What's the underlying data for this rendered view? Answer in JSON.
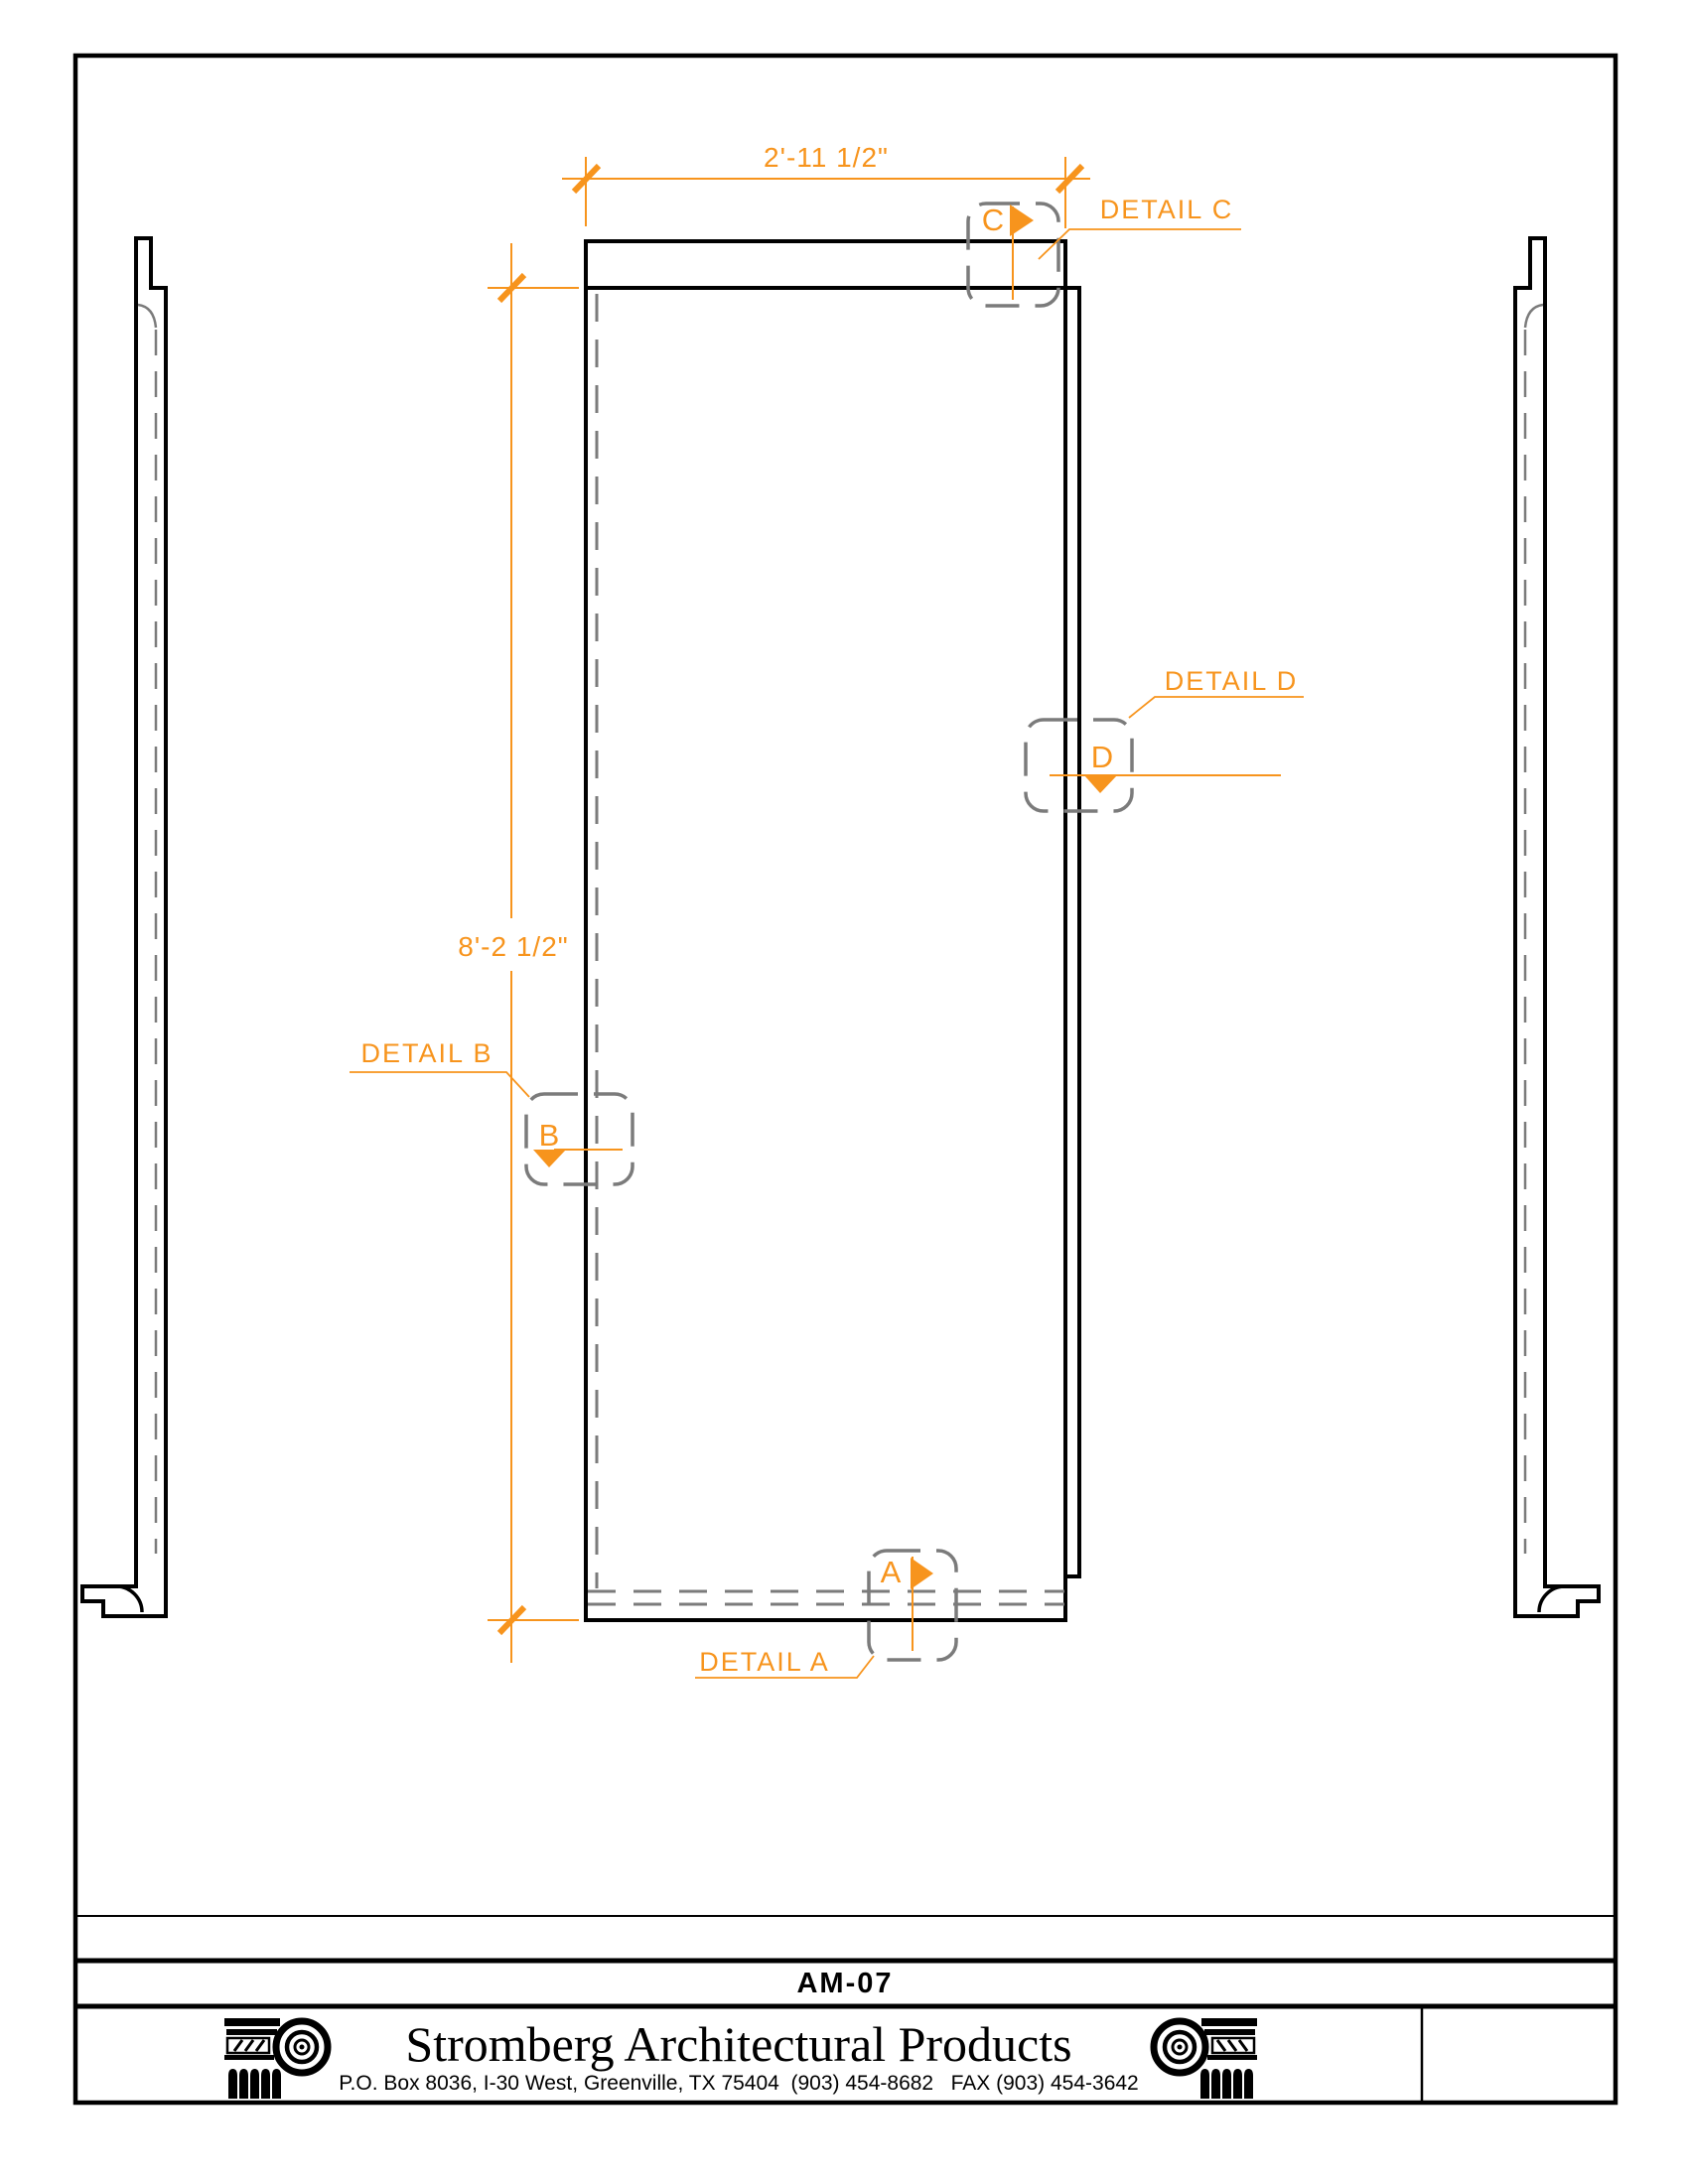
{
  "drawing": {
    "width_dimension": "2'-11 1/2\"",
    "height_dimension": "8'-2 1/2\"",
    "details": [
      {
        "letter": "A",
        "label": "DETAIL A"
      },
      {
        "letter": "B",
        "label": "DETAIL B"
      },
      {
        "letter": "C",
        "label": "DETAIL C"
      },
      {
        "letter": "D",
        "label": "DETAIL D"
      }
    ],
    "colors": {
      "accent": "#F7941D",
      "hidden_line": "#7B7B7B",
      "object_line": "#000000"
    }
  },
  "title_block": {
    "sheet_number": "AM-07",
    "company": "Stromberg Architectural Products",
    "address": "P.O. Box 8036, I-30 West, Greenville, TX 75404  (903) 454-8682   FAX (903) 454-3642"
  }
}
